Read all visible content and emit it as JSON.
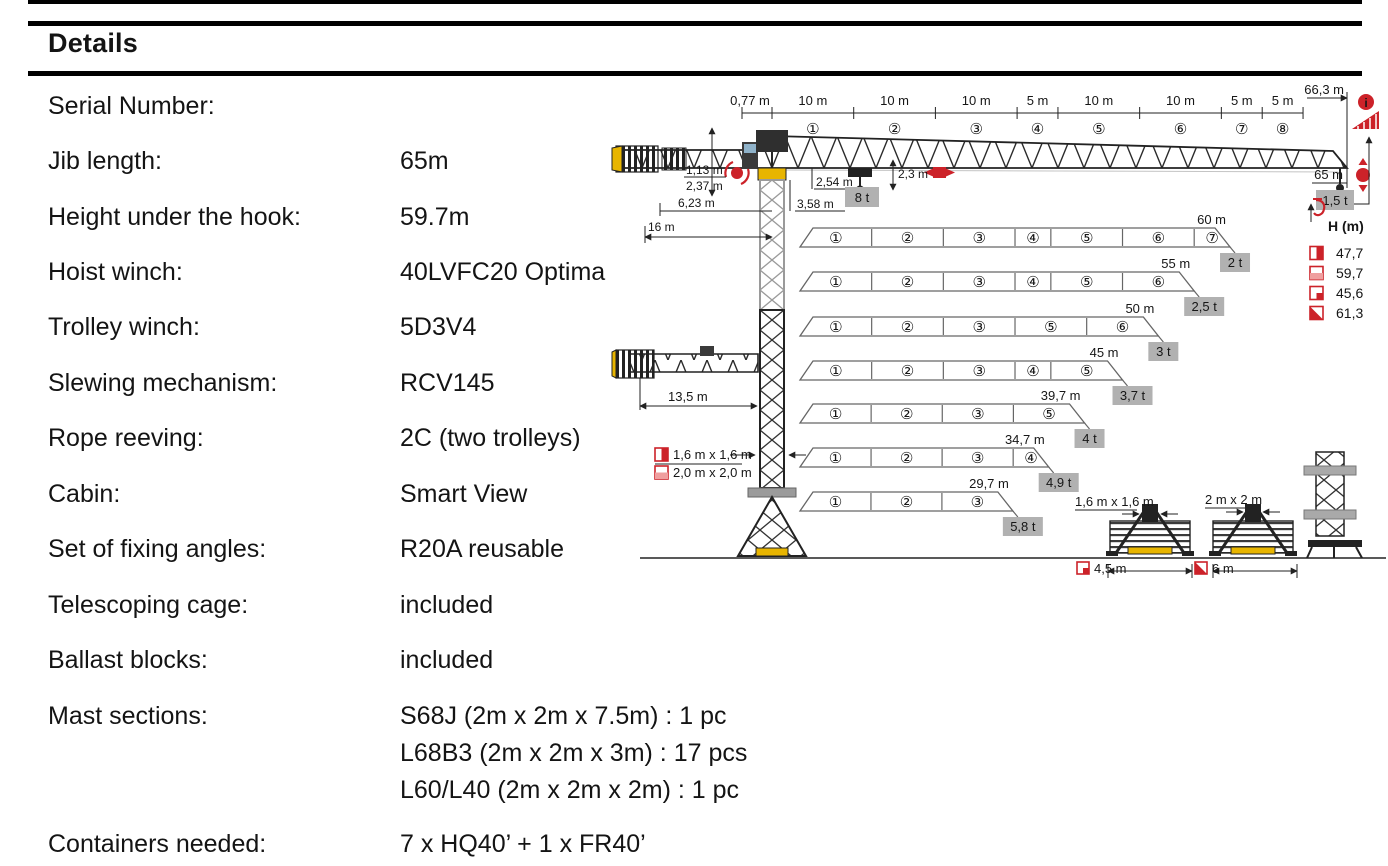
{
  "page": {
    "title": "Details"
  },
  "details": {
    "rows": [
      {
        "label": "Serial Number:",
        "value": ""
      },
      {
        "label": "Jib length:",
        "value": "65m"
      },
      {
        "label": "Height under the hook:",
        "value": "59.7m"
      },
      {
        "label": "Hoist winch:",
        "value": "40LVFC20 Optima"
      },
      {
        "label": "Trolley winch:",
        "value": "5D3V4"
      },
      {
        "label": "Slewing mechanism:",
        "value": "RCV145"
      },
      {
        "label": "Rope reeving:",
        "value": "2C (two trolleys)"
      },
      {
        "label": "Cabin:",
        "value": "Smart View"
      },
      {
        "label": "Set of fixing angles:",
        "value": "R20A reusable"
      },
      {
        "label": "Telescoping cage:",
        "value": "included"
      },
      {
        "label": "Ballast blocks:",
        "value": "included"
      },
      {
        "label": "Mast sections:",
        "value": [
          "S68J (2m x 2m x 7.5m) : 1 pc",
          "L68B3 (2m x 2m x 3m) : 17 pcs",
          "L60/L40 (2m x 2m x 2m) : 1 pc"
        ]
      },
      {
        "label": "Containers needed:",
        "value": "7 x HQ40’ + 1 x FR40’"
      }
    ]
  },
  "diagram": {
    "top_chain": {
      "root": "0,77 m",
      "total": "66,3 m",
      "sections": [
        {
          "len": "10 m",
          "num": "①",
          "w": 10
        },
        {
          "len": "10 m",
          "num": "②",
          "w": 10
        },
        {
          "len": "10 m",
          "num": "③",
          "w": 10
        },
        {
          "len": "5 m",
          "num": "④",
          "w": 5
        },
        {
          "len": "10 m",
          "num": "⑤",
          "w": 10
        },
        {
          "len": "10 m",
          "num": "⑥",
          "w": 10
        },
        {
          "len": "5 m",
          "num": "⑦",
          "w": 5
        },
        {
          "len": "5 m",
          "num": "⑧",
          "w": 5
        }
      ]
    },
    "elevation": {
      "jib_h1": "1,13 m",
      "jib_h2": "2,37 m",
      "cjib_w": "6,23 m",
      "cjib_r": "16 m",
      "head_h": "3,58 m",
      "trolley_h": "2,54 m",
      "hook_h": "2,3 m",
      "max_load": "8 t",
      "tip_radius": "65 m",
      "tip_load": "1,5 t"
    },
    "alt_view_dim": "13,5 m",
    "mast_sizes": [
      {
        "icon": "v",
        "label": "1,6 m x 1,6 m"
      },
      {
        "icon": "h",
        "label": "2,0 m x 2,0 m"
      }
    ],
    "legend": {
      "title": "H (m)",
      "rows": [
        {
          "icon": "v",
          "value": "47,7"
        },
        {
          "icon": "h",
          "value": "59,7"
        },
        {
          "icon": "q",
          "value": "45,6"
        },
        {
          "icon": "d",
          "value": "61,3"
        }
      ]
    },
    "configs": [
      {
        "length_m": 60,
        "length": "60 m",
        "load": "2 t",
        "sections": [
          "①",
          "②",
          "③",
          "④",
          "⑤",
          "⑥",
          "⑦"
        ],
        "widths": [
          10,
          10,
          10,
          5,
          10,
          10,
          5
        ]
      },
      {
        "length_m": 55,
        "length": "55 m",
        "load": "2,5 t",
        "sections": [
          "①",
          "②",
          "③",
          "④",
          "⑤",
          "⑥"
        ],
        "widths": [
          10,
          10,
          10,
          5,
          10,
          10
        ]
      },
      {
        "length_m": 50,
        "length": "50 m",
        "load": "3 t",
        "sections": [
          "①",
          "②",
          "③",
          "⑤",
          "⑥"
        ],
        "widths": [
          10,
          10,
          10,
          10,
          10
        ]
      },
      {
        "length_m": 45,
        "length": "45 m",
        "load": "3,7 t",
        "sections": [
          "①",
          "②",
          "③",
          "④",
          "⑤"
        ],
        "widths": [
          10,
          10,
          10,
          5,
          10
        ]
      },
      {
        "length_m": 39.7,
        "length": "39,7 m",
        "load": "4 t",
        "sections": [
          "①",
          "②",
          "③",
          "⑤"
        ],
        "widths": [
          10,
          10,
          10,
          10
        ]
      },
      {
        "length_m": 34.7,
        "length": "34,7 m",
        "load": "4,9 t",
        "sections": [
          "①",
          "②",
          "③",
          "④"
        ],
        "widths": [
          10,
          10,
          10,
          5
        ]
      },
      {
        "length_m": 29.7,
        "length": "29,7 m",
        "load": "5,8 t",
        "sections": [
          "①",
          "②",
          "③"
        ],
        "widths": [
          10,
          10,
          10
        ]
      }
    ],
    "bases": [
      {
        "size": "1,6 m x 1,6 m",
        "width": "4,5 m",
        "icon": "q"
      },
      {
        "size": "2 m x 2 m",
        "width": "6 m",
        "icon": "d"
      }
    ]
  },
  "colors": {
    "red": "#cc2229",
    "yellow": "#e8b500",
    "tag_bg": "#b1b1b1",
    "ink": "#161616"
  }
}
